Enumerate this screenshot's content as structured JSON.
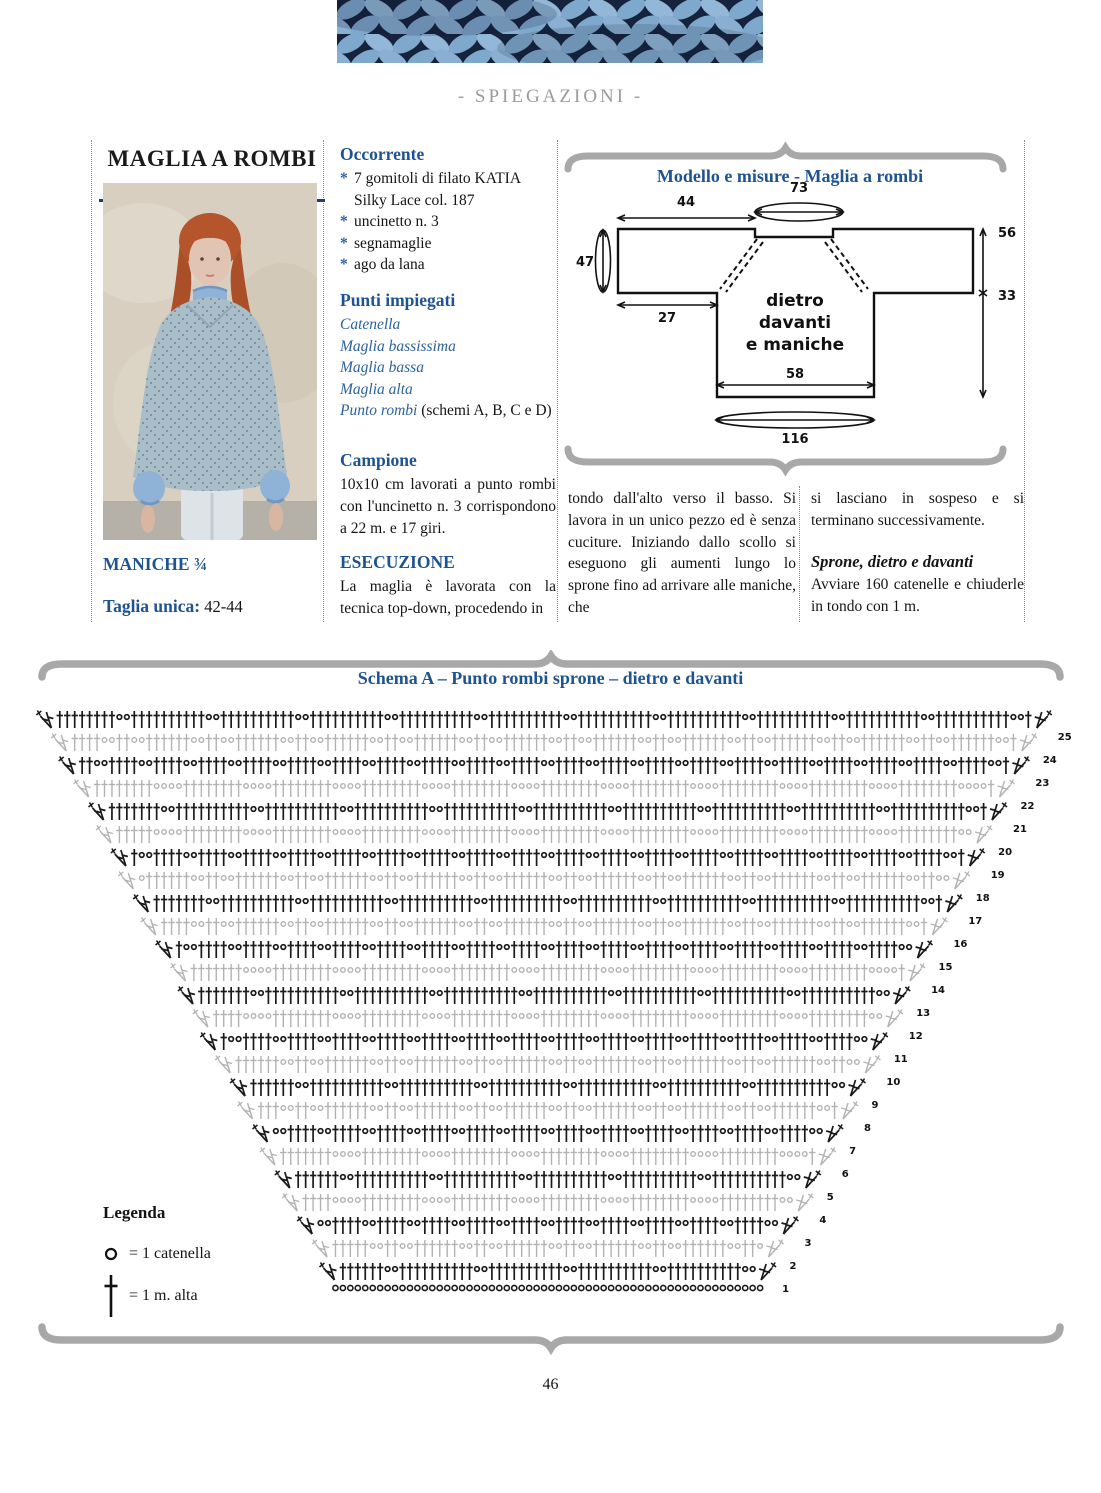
{
  "page": {
    "number": "46",
    "section_label": "- SPIEGAZIONI -"
  },
  "colors": {
    "heading_blue": "#1e5393",
    "rule_navy": "#1c3f77",
    "text": "#141414",
    "brace_gray": "#a8a8a8",
    "chart_black": "#1a1a1a",
    "chart_gray": "#b2b2b2",
    "photo_sweater": "#a9bec9",
    "photo_shirt": "#8fb3d6",
    "banner_navy": "#16233c",
    "banner_yarn": "#7fa8cd"
  },
  "article": {
    "title": "MAGLIA A ROMBI",
    "sleeves_note": "MANICHE ¾",
    "size_label": "Taglia unica:",
    "size_value": " 42-44"
  },
  "occorrente": {
    "heading": "Occorrente",
    "items": [
      {
        "bullet": "*",
        "text": "7 gomitoli di filato KATIA Silky Lace col. 187"
      },
      {
        "bullet": "*",
        "text": "uncinetto n. 3"
      },
      {
        "bullet": "*",
        "text": "segnamaglie"
      },
      {
        "bullet": "*",
        "text": "ago da lana"
      }
    ]
  },
  "punti": {
    "heading": "Punti impiegati",
    "items": [
      {
        "text": "Catenella",
        "cls": "st"
      },
      {
        "text": "Maglia bassissima",
        "cls": "st"
      },
      {
        "text": "Maglia bassa",
        "cls": "st"
      },
      {
        "text": "Maglia alta",
        "cls": "st"
      },
      {
        "text": "Punto rombi",
        "cls": "st",
        "suffix": " (schemi A, B, C e D)"
      }
    ]
  },
  "campione": {
    "heading": "Campione",
    "text": "10x10 cm lavorati a punto rombi con l'uncinetto n. 3 corrispondono a 22 m. e 17 giri."
  },
  "esecuzione": {
    "heading": "ESECUZIONE",
    "col0": "La maglia è lavorata con la tecnica top-down, procedendo in",
    "col1": "tondo dall'alto verso il basso. Si lavora in un unico pezzo ed è senza cuciture. Iniziando dallo scollo si eseguono gli aumenti lungo lo sprone fino ad arrivare alle maniche, che",
    "col2": "si lasciano in sospeso e si terminano successivamente."
  },
  "sprone": {
    "heading": "Sprone, dietro e davanti",
    "text": "Avviare 160 catenelle e chiuderle in tondo con 1 m."
  },
  "model_panel": {
    "title": "Modello e misure - Maglia a rombi",
    "center_label": [
      "dietro",
      "davanti",
      "e maniche"
    ],
    "measurements": {
      "shoulder_width": "44",
      "neck_round": "73",
      "side_total": "56",
      "sleeve_depth": "47",
      "sleeve_width": "27",
      "body_side": "33",
      "body_width": "58",
      "bottom_round": "116"
    }
  },
  "chart": {
    "legend": {
      "heading": "Legenda",
      "chain": "= 1 catenella",
      "treble": "= 1 m. alta"
    }
  },
  "chart_data": {
    "type": "crochet-diagram",
    "title": "Schema A – Punto rombi sprone – dietro e davanti",
    "rows": 25,
    "numbering": "rows numbered 1 (bottom) to 25 (top) along the right edge",
    "row_style": {
      "odd": "black",
      "even": "gray"
    },
    "legend": [
      {
        "symbol": "o",
        "meaning": "1 catenella"
      },
      {
        "symbol": "†",
        "meaning": "1 m. alta"
      }
    ],
    "structure": "trapezoid worked top-down: foundation chain at bottom, fan increases at both row ends, diamond (rombi) lattice of chain pairs between trebles",
    "geometry": {
      "row1_y": 630,
      "row_pitch": 23,
      "row1_left": 341,
      "row1_right": 756,
      "left_slope": 11.8,
      "right_slope": 11.45,
      "stitch_pitch": 7.45,
      "diamond_period": 12,
      "diamond_rows": 8
    }
  }
}
